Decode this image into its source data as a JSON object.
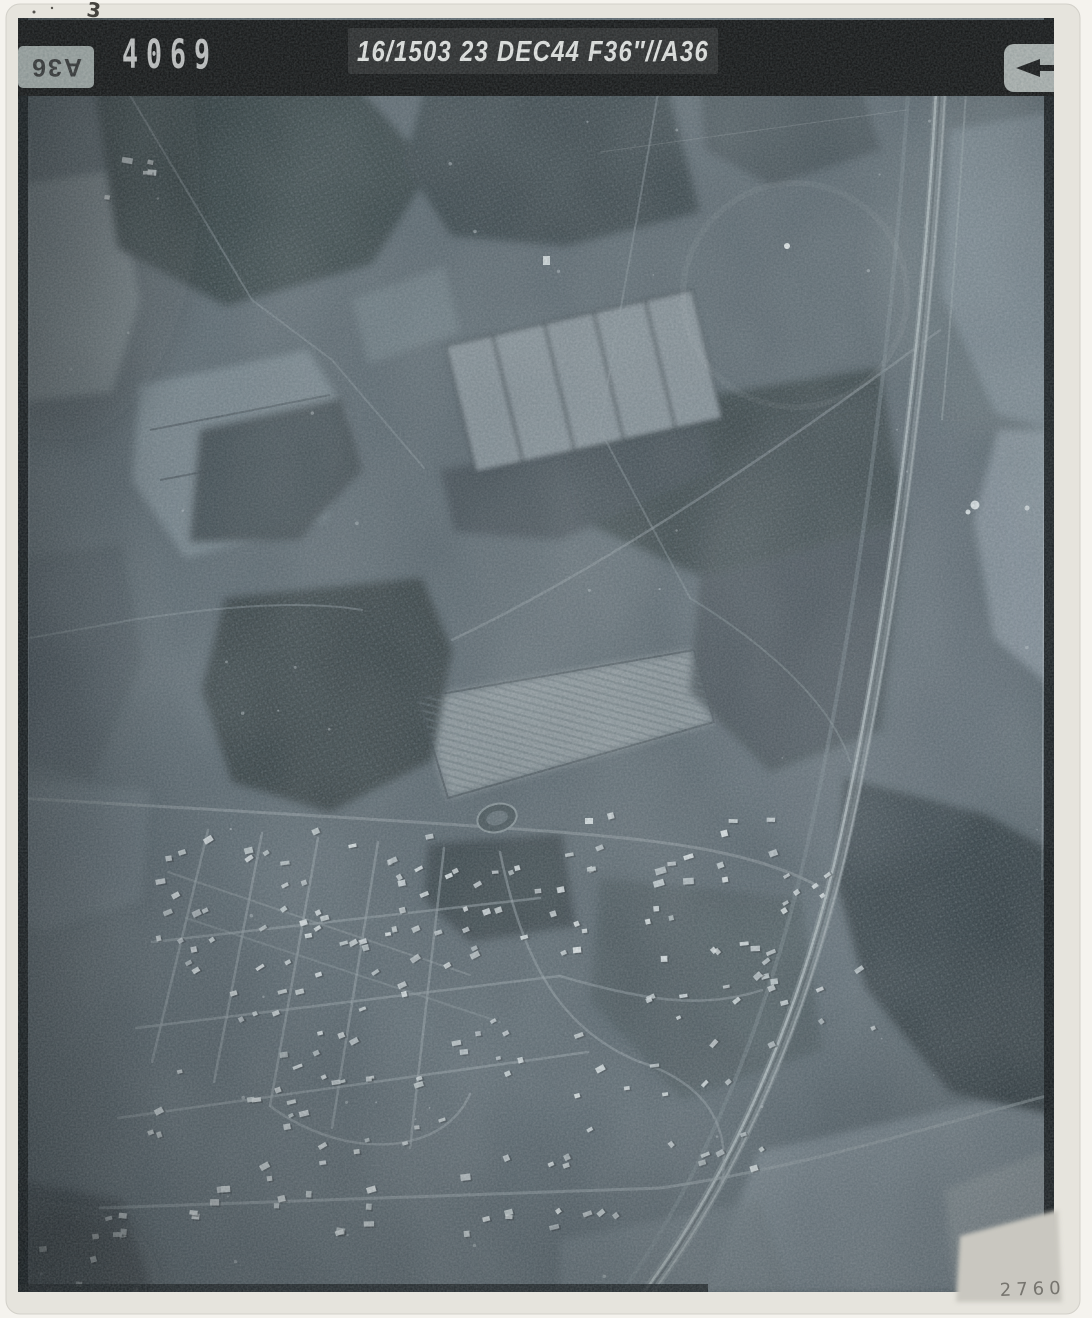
{
  "photo_annotations": {
    "frame_number": "4069",
    "caption": "16/1503 23 DEC44 F36″//A36",
    "edge_tab_label": "A36",
    "pencil_number": "2760",
    "corner_mark": "3"
  },
  "icons": {
    "arrow": "left-arrow-icon"
  },
  "palette": {
    "scan_background": "#f5f3ee",
    "paper": "#e6e4dd",
    "strip_black": "#0b0b0b",
    "caption_box": "#242424",
    "stamp_white": "#d9d9d7",
    "text_white": "#efefec",
    "photo_base": "#57636b",
    "forest_dark": "#2f3a3e",
    "field_light": "#8a949a",
    "railway_light": "#b4bec2",
    "pencil_gray": "#76746e"
  }
}
